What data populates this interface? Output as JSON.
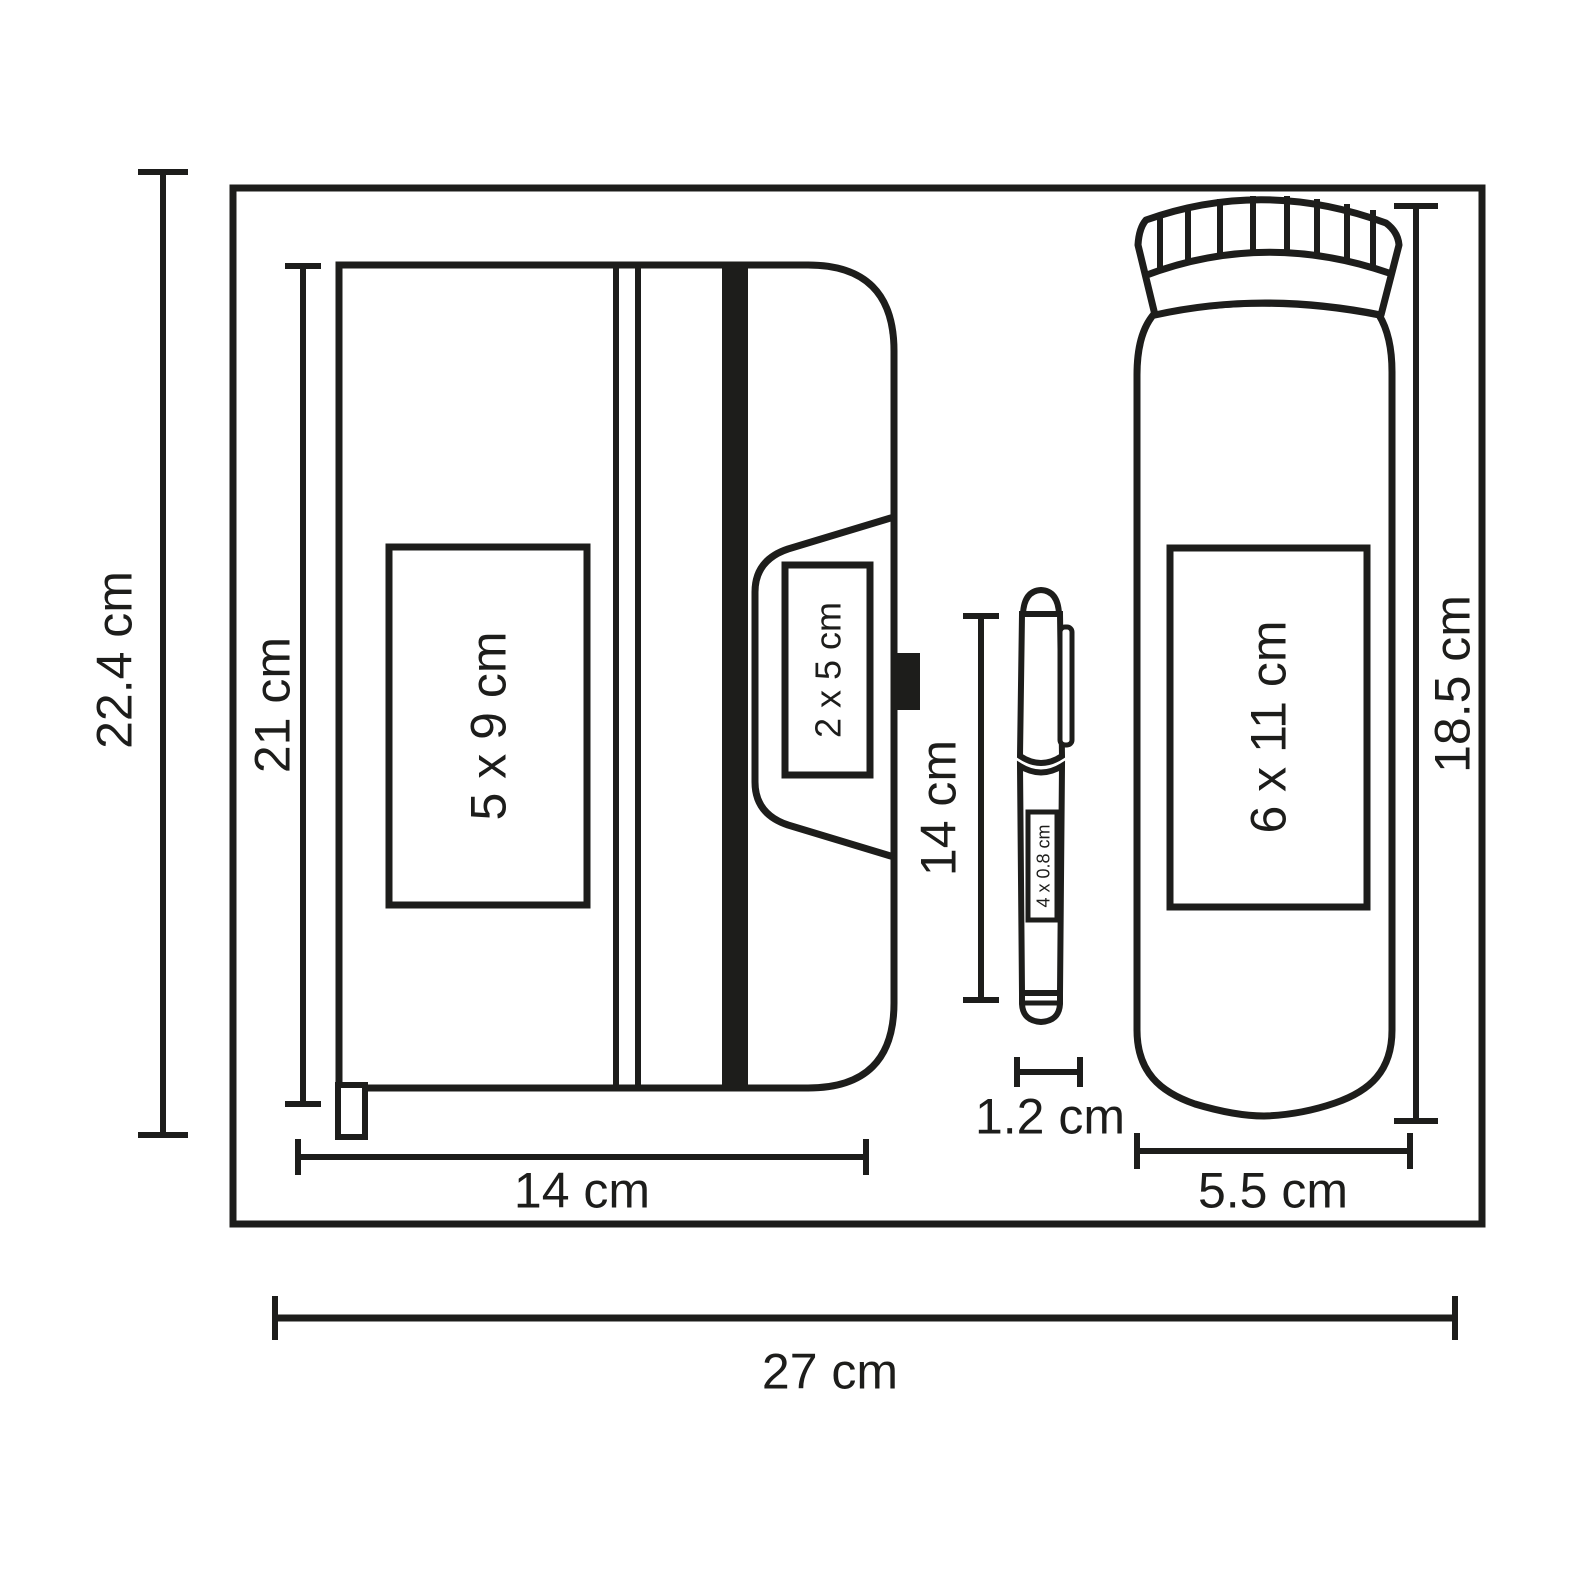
{
  "diagram": {
    "description": "Gift set dimension drawing: notebook, pen and sport bottle inside outer box",
    "colors": {
      "line": "#1d1d1b",
      "background": "#ffffff"
    },
    "labels": {
      "outer_height": "22.4 cm",
      "outer_width": "27 cm",
      "notebook_height": "21 cm",
      "notebook_width": "14 cm",
      "notebook_print_area": "5 x 9 cm",
      "flap_print_area": "2 x 5 cm",
      "pen_length": "14 cm",
      "pen_diameter": "1.2 cm",
      "pen_print_area": "4 x 0.8 cm",
      "bottle_height": "18.5 cm",
      "bottle_width": "5.5 cm",
      "bottle_print_area": "6 x 11 cm"
    }
  }
}
